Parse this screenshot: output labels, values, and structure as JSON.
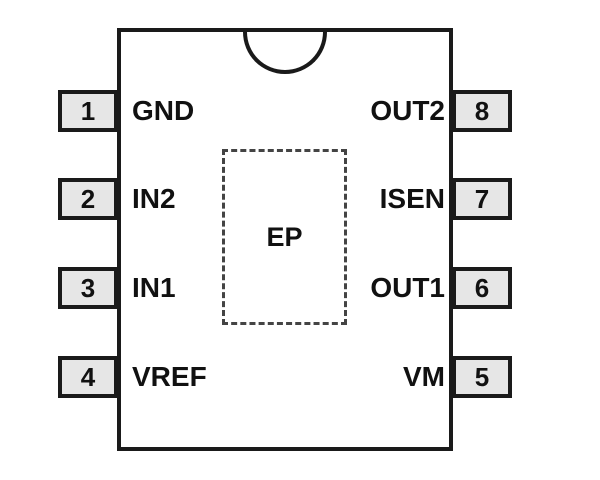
{
  "diagram": {
    "type": "ic-pinout",
    "package_label": "EP",
    "pins": {
      "left": [
        {
          "number": "1",
          "name": "GND"
        },
        {
          "number": "2",
          "name": "IN2"
        },
        {
          "number": "3",
          "name": "IN1"
        },
        {
          "number": "4",
          "name": "VREF"
        }
      ],
      "right": [
        {
          "number": "8",
          "name": "OUT2"
        },
        {
          "number": "7",
          "name": "ISEN"
        },
        {
          "number": "6",
          "name": "OUT1"
        },
        {
          "number": "5",
          "name": "VM"
        }
      ]
    },
    "colors": {
      "background": "#ffffff",
      "line": "#1a1a1a",
      "pin_fill": "#e6e6e6",
      "dashed": "#444444",
      "text": "#111111"
    }
  }
}
